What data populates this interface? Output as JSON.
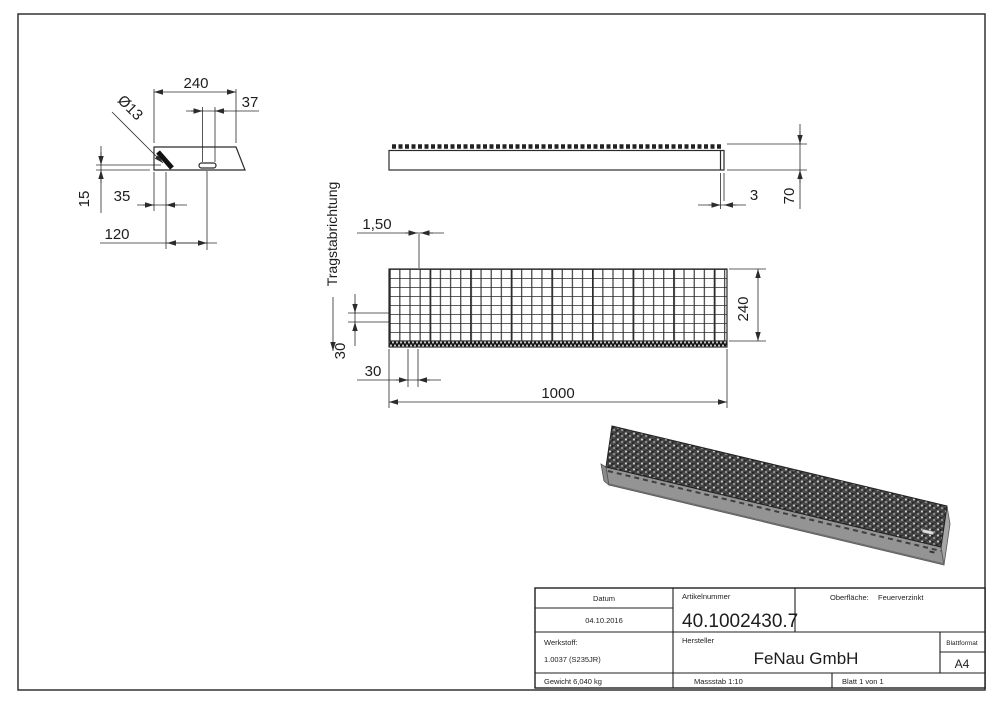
{
  "views": {
    "detail_view": {
      "dim_width": "240",
      "dim_slot": "37",
      "hole_label": "Ø13",
      "dim_height": "15",
      "dim_hole_offset": "35",
      "dim_slot_offset": "120"
    },
    "side_view": {
      "dim_thickness": "3",
      "dim_height": "70"
    },
    "plan_view": {
      "dim_bar_width": "1,50",
      "dim_mesh_y": "30",
      "dim_mesh_x": "30",
      "dim_length": "1000",
      "dim_depth": "240",
      "direction_label": "Tragstabrichtung"
    }
  },
  "title_block": {
    "datum_label": "Datum",
    "datum_value": "04.10.2016",
    "artikelnummer_label": "Artikelnummer",
    "artikelnummer_value": "40.1002430.7",
    "oberflaeche_label": "Oberfläche:",
    "oberflaeche_value": "Feuerverzinkt",
    "werkstoff_label": "Werkstoff:",
    "werkstoff_value": "1.0037 (S235JR)",
    "hersteller_label": "Hersteller",
    "hersteller_value": "FeNau GmbH",
    "blattformat_label": "Blattformat",
    "blattformat_value": "A4",
    "gewicht_value": "Gewicht 6,040 kg",
    "massstab_value": "Massstab 1:10",
    "blatt_value": "Blatt 1 von 1"
  },
  "colors": {
    "line": "#2b2b2b",
    "background": "#ffffff",
    "iso_side": "#949494",
    "iso_end": "#a6a6a6",
    "iso_left_end": "#8a8a8a",
    "iso_mesh_dark": "#4a4a4a"
  }
}
